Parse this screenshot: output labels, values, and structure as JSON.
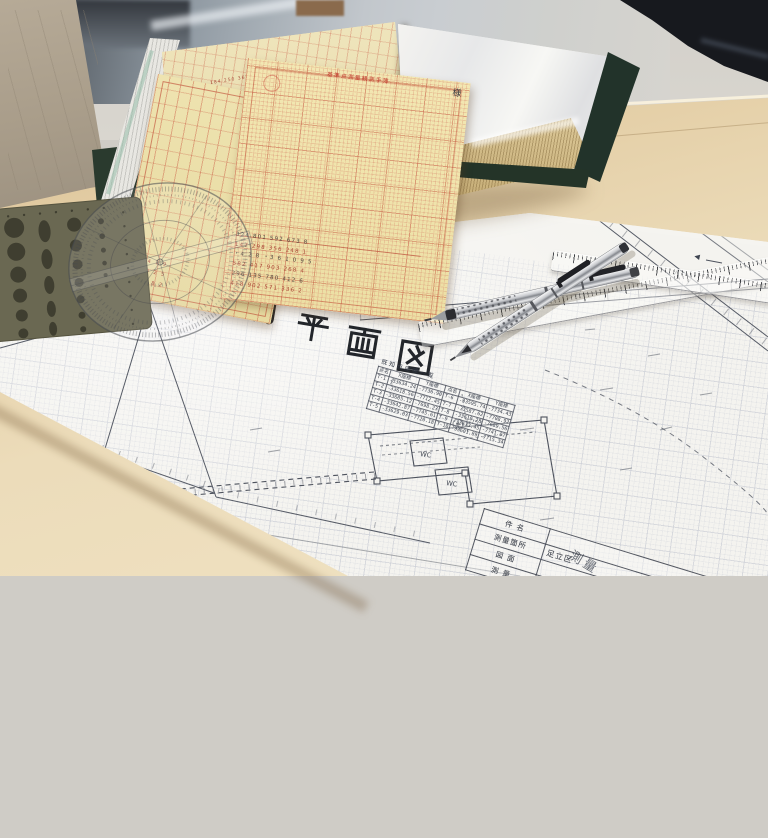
{
  "plan": {
    "title": "現況平面図",
    "coord_table": {
      "title": "既知点座標一覧",
      "headers": [
        "点名",
        "X座標",
        "Y座標",
        "点名",
        "X座標",
        "Y座標"
      ],
      "rows": [
        [
          "T-1",
          "-33634.24",
          "-7736.90",
          "T-6",
          "-33595.74",
          "-7734.43"
        ],
        [
          "T-2",
          "-33618.56",
          "-7712.45",
          "T-7",
          "-33587.62",
          "-7708.92"
        ],
        [
          "T-3",
          "-33605.12",
          "-7698.23",
          "T-8",
          "-33610.28",
          "-7689.56"
        ],
        [
          "T-4",
          "-33642.87",
          "-7745.61",
          "T-9",
          "-33633.45",
          "-7741.07"
        ],
        [
          "T-5",
          "-33629.03",
          "-7720.18",
          "T-10",
          "-33601.89",
          "-7715.34"
        ]
      ]
    },
    "title_block": {
      "rows": [
        {
          "label": "件 名",
          "value": ""
        },
        {
          "label": "測量箇所",
          "value": "足立区"
        },
        {
          "label": "図 面",
          "value": ""
        },
        {
          "label": "測 量",
          "value": ""
        }
      ],
      "watermark": "測量"
    },
    "annotations": {
      "benchmark": "G753",
      "wc": "WC",
      "length_symbol": "ℓ",
      "north_arrow": "◀"
    }
  },
  "forms": {
    "front": {
      "header": "基準点測量観測手簿",
      "corner_note": "様",
      "rows": [
        "324 801 592 673 8",
        "147 298 356 248 1",
        "・4 2 8 ・3 6 1 0 9 5",
        "582 417 903 268 4",
        "296 135 780 412 6",
        "418 902 571 336 2"
      ]
    },
    "left": {
      "rows": [
        "8 2 4 1 9",
        "3 6 0 2 5",
        "7 1 4 8 2"
      ]
    }
  },
  "binder": {
    "page_marks": [
      "184 250 365",
      "240 118 306",
      "152 493 270",
      "318 264 150"
    ]
  },
  "colors": {
    "wood": "#ecdcba",
    "sheet": "#f4f3ef",
    "grid_line": "#aab0c2",
    "form_yellow": "#f0e4ad",
    "form_red": "#c0392b",
    "binder_green": "#243428",
    "stencil_olive": "#6a6852",
    "ink": "#4d525d"
  }
}
